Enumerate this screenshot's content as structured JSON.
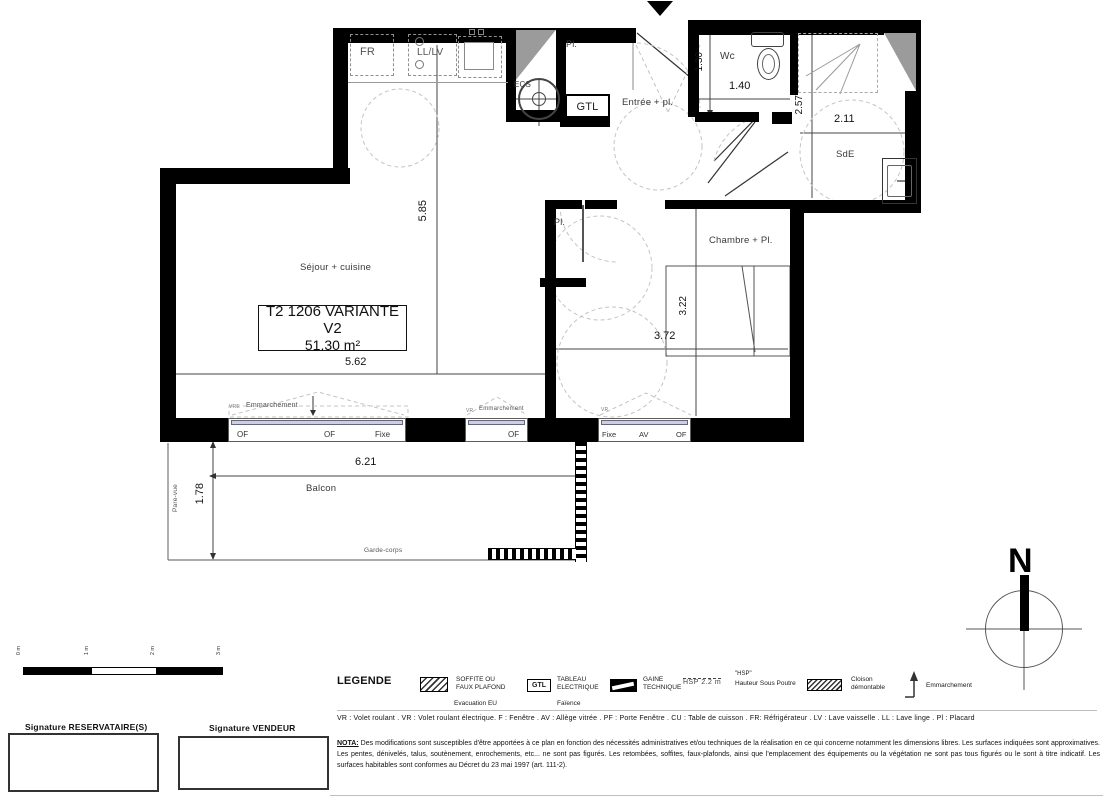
{
  "plan": {
    "unit": {
      "name": "T2 1206 VARIANTE V2",
      "area": "51.30 m²"
    },
    "rooms": {
      "sejour": "Séjour + cuisine",
      "chambre": "Chambre + Pl.",
      "entree": "Entrée + pl.",
      "wc": "Wc",
      "sde": "SdE",
      "balcon": "Balcon",
      "placard_entree": "Pl.",
      "placard_chambre": "Pl."
    },
    "equipment": {
      "fridge": "FR",
      "washer": "LL/LV",
      "water_heater": "ECS",
      "electrical_box": "GTL"
    },
    "dims": {
      "sejour_h": "5.85",
      "sejour_w": "5.62",
      "wc_h": "1.30",
      "wc_w": "1.40",
      "sde_h": "2.57",
      "sde_w": "2.11",
      "chambre_h": "3.22",
      "chambre_w": "3.72",
      "balcon_w": "6.21",
      "balcon_d": "1.78"
    },
    "balcony": {
      "pare_vue": "Pare-vue",
      "garde_corps": "Garde-corps"
    },
    "windows": {
      "w1": {
        "motor": "VRE",
        "step": "Emmarchement",
        "panes": [
          "OF",
          "OF",
          "Fixe"
        ]
      },
      "w2": {
        "motor": "VR",
        "step": "Emmarchement",
        "panes": [
          "OF"
        ]
      },
      "w3": {
        "motor": "VR",
        "panes": [
          "Fixe",
          "AV",
          "OF"
        ]
      }
    },
    "compass": {
      "north": "N"
    }
  },
  "scalebar": {
    "ticks": [
      "0 m",
      "1 m",
      "2 m",
      "3 m"
    ]
  },
  "legend": {
    "title": "LEGENDE",
    "soffite_1": "SOFFITE OU",
    "soffite_2": "FAUX PLAFOND",
    "evacuation": "Evacuation EU",
    "gtl_symbol": "GTL",
    "tableau_1": "TABLEAU",
    "tableau_2": "ELECTRIQUE",
    "faience": "Faïence",
    "gaine_1": "GAINE",
    "gaine_2": "TECHNIQUE",
    "hsp_sample": "HSP 2.2 m",
    "hsp_1": "\"HSP\"",
    "hsp_2": "Hauteur Sous Poutre",
    "cloison_1": "Cloison",
    "cloison_2": "démontable",
    "emmarchement": "Emmarchement"
  },
  "footer": {
    "abbreviations": "VR : Volet roulant . VR : Volet roulant électrique. F : Fenêtre . AV : Allège vitrée . PF : Porte Fenêtre . CU : Table de cuisson . FR: Réfrigérateur . LV : Lave vaisselle . LL : Lave linge . Pl : Placard",
    "nota_label": "NOTA:",
    "nota_text": " Des modifications sont susceptibles d'être apportées à ce plan en fonction des nécessités administratives et/ou techniques de la réalisation en ce qui concerne notamment les dimensions libres. Les surfaces indiquées sont approximatives. Les pentes, dénivelés, talus, soutènement, enrochements, etc... ne sont pas figurés. Les retombées, soffites, faux-plafonds, ainsi que l'emplacement des équipements ou la végétation ne sont pas tous figurés ou le sont à titre indicatif. Les surfaces habitables sont conformes au Décret du 23 mai 1997 (art. 111-2).",
    "sig_left": "Signature RESERVATAIRE(S)",
    "sig_right": "Signature VENDEUR"
  }
}
